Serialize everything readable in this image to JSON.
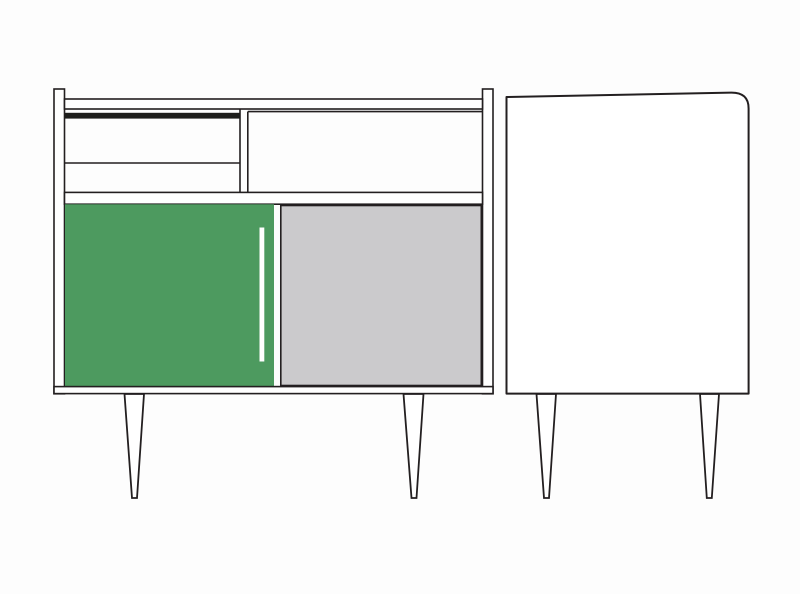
{
  "canvas": {
    "width": 800,
    "height": 594,
    "background": "#fdfdfd"
  },
  "colors": {
    "line": "#231f20",
    "white": "#ffffff",
    "green": "#4d9a5f",
    "gray": "#cbcacc",
    "black_bar": "#1d1d1b"
  }
}
